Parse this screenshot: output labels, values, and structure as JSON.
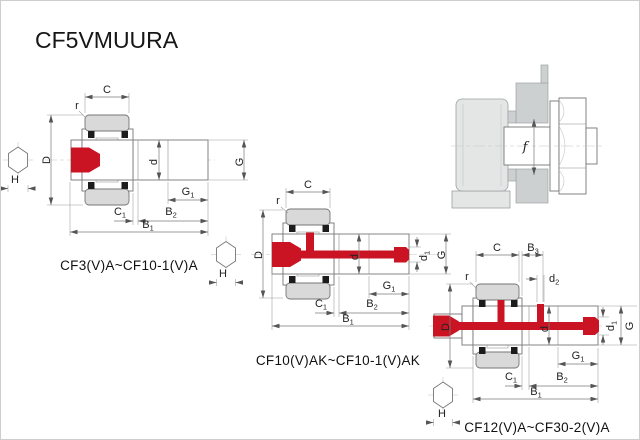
{
  "page": {
    "title": "CF5VMUURA"
  },
  "colors": {
    "accent_red": "#cb1423",
    "bearing_gray": "#d9d9d9",
    "housing_gray": "#ccd0d0"
  },
  "labels": {
    "C": "C",
    "r": "r",
    "D": "D",
    "H": "H",
    "d": "d",
    "G": "G",
    "f": "f",
    "G1": {
      "base": "G",
      "sub": "1"
    },
    "C1": {
      "base": "C",
      "sub": "1"
    },
    "B1": {
      "base": "B",
      "sub": "1"
    },
    "B2": {
      "base": "B",
      "sub": "2"
    },
    "B3": {
      "base": "B",
      "sub": "3"
    },
    "d1": {
      "base": "d",
      "sub": "1"
    },
    "d2": {
      "base": "d",
      "sub": "2"
    }
  },
  "diagrams": [
    {
      "caption": "CF3(V)A~CF10-1(V)A",
      "dimensions_shown": [
        "C",
        "r",
        "D",
        "H",
        "d",
        "G",
        "G1",
        "C1",
        "B2",
        "B1"
      ]
    },
    {
      "caption": "CF10(V)AK~CF10-1(V)AK",
      "dimensions_shown": [
        "C",
        "r",
        "D",
        "H",
        "d",
        "d1",
        "G",
        "G1",
        "C1",
        "B2",
        "B1"
      ]
    },
    {
      "caption": "CF12(V)A~CF30-2(V)A",
      "dimensions_shown": [
        "C",
        "B3",
        "d2",
        "r",
        "D",
        "H",
        "d",
        "d1",
        "G",
        "G1",
        "C1",
        "B2",
        "B1"
      ]
    }
  ],
  "mounting": {
    "clearance_label": "f"
  }
}
